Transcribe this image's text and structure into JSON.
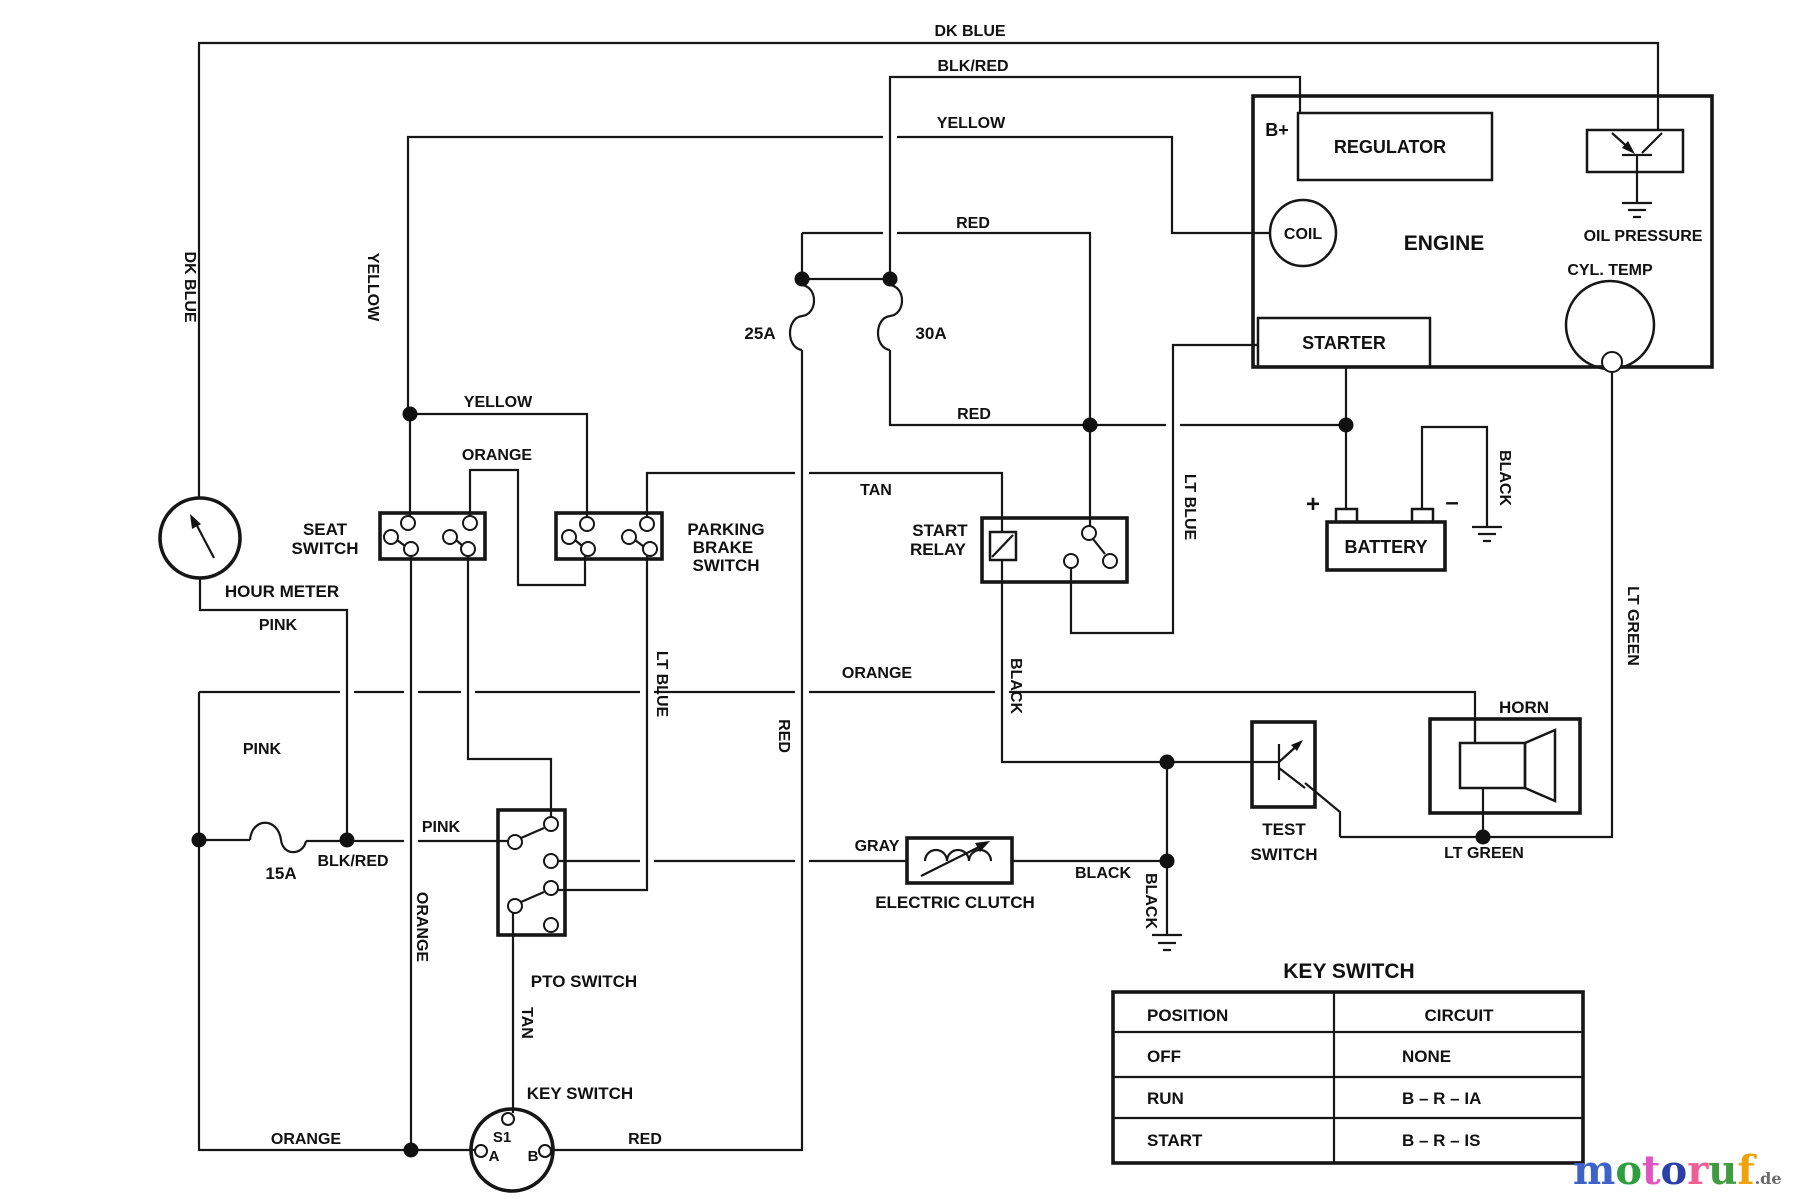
{
  "labels": {
    "dk_blue_top": "DK BLUE",
    "blk_red_top": "BLK/RED",
    "yellow_top": "YELLOW",
    "red_top": "RED",
    "dk_blue_left": "DK BLUE",
    "yellow_left": "YELLOW",
    "b_plus": "B+",
    "regulator": "REGULATOR",
    "coil": "COIL",
    "engine": "ENGINE",
    "oil_pressure": "OIL PRESSURE",
    "cyl_temp": "CYL. TEMP",
    "starter": "STARTER",
    "battery": "BATTERY",
    "plus": "+",
    "minus": "–",
    "black_battery": "BLACK",
    "seat_switch_line1": "SEAT",
    "seat_switch_line2": "SWITCH",
    "parking_line1": "PARKING",
    "parking_line2": "BRAKE",
    "parking_line3": "SWITCH",
    "yellow_seat": "YELLOW",
    "orange_seat": "ORANGE",
    "tan_relay": "TAN",
    "start_relay_line1": "START",
    "start_relay_line2": "RELAY",
    "red_mid": "RED",
    "lt_blue_mid": "LT BLUE",
    "lt_blue_right": "LT BLUE",
    "hour_meter": "HOUR METER",
    "pink_top": "PINK",
    "pink_mid": "PINK",
    "pink_fuse": "PINK",
    "fuse_15": "15A",
    "blk_red_fuse": "BLK/RED",
    "fuse_25": "25A",
    "fuse_30": "30A",
    "orange_vert": "ORANGE",
    "orange_long": "ORANGE",
    "orange_bottom": "ORANGE",
    "yellow_pto": "YELLOW",
    "red_vert": "RED",
    "black_relay": "BLACK",
    "black_ground": "BLACK",
    "gray": "GRAY",
    "electric_clutch": "ELECTRIC CLUTCH",
    "black_clutch": "BLACK",
    "test_line1": "TEST",
    "test_line2": "SWITCH",
    "horn": "HORN",
    "lt_green_horn": "LT GREEN",
    "lt_green_right": "LT GREEN",
    "pto_switch": "PTO SWITCH",
    "tan_vert": "TAN",
    "key_switch": "KEY SWITCH",
    "s1": "S1",
    "term_a": "A",
    "term_b": "B",
    "red_bottom": "RED"
  },
  "table": {
    "title": "KEY SWITCH",
    "col_position": "POSITION",
    "col_circuit": "CIRCUIT",
    "rows": [
      {
        "position": "OFF",
        "circuit": "NONE"
      },
      {
        "position": "RUN",
        "circuit": "B – R – IA"
      },
      {
        "position": "START",
        "circuit": "B – R – IS"
      }
    ]
  },
  "logo": {
    "letters": [
      {
        "ch": "m",
        "color": "#3d63c9"
      },
      {
        "ch": "o",
        "color": "#2f9e3f"
      },
      {
        "ch": "t",
        "color": "#e254c2"
      },
      {
        "ch": "o",
        "color": "#2b3fa8"
      },
      {
        "ch": "r",
        "color": "#ef5e96"
      },
      {
        "ch": "u",
        "color": "#3f9c3f"
      },
      {
        "ch": "f",
        "color": "#f0a30a"
      }
    ],
    "suffix": ".de",
    "suffix_color": "#6a6a6a"
  }
}
